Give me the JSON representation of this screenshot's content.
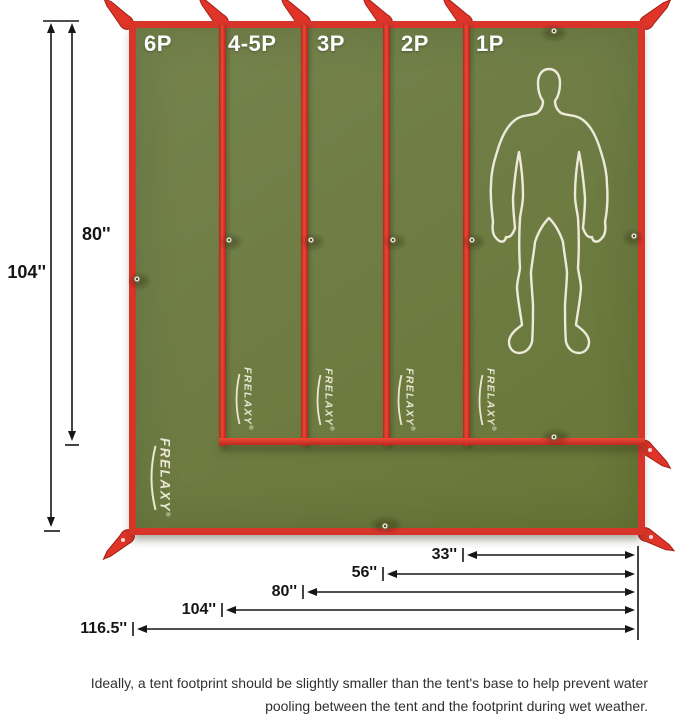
{
  "panels": [
    "6P",
    "4-5P",
    "3P",
    "2P",
    "1P"
  ],
  "brand": {
    "name": "FRELAXY",
    "registered": "®"
  },
  "dimensions": {
    "left": [
      "104''",
      "80''"
    ],
    "bottom": [
      "33''",
      "56''",
      "80''",
      "104''",
      "116.5''"
    ]
  },
  "caption": {
    "line1": "Ideally, a tent footprint should be slightly smaller than the tent's base to help prevent water",
    "line2": "pooling between the tent and the footprint during wet weather."
  },
  "icons": {
    "silhouette": "human-figure-outline-icon",
    "strap": "tent-corner-strap-icon",
    "grommet": "grommet-eyelet-icon",
    "swoosh": "brand-swoosh-icon"
  },
  "colors": {
    "tarp_green": "#6f7d45",
    "border_red": "#d8352a",
    "panel_label": "#ffffff",
    "logo_text": "#ece7d2",
    "dimension_text": "#151515",
    "caption_text": "#303030"
  }
}
